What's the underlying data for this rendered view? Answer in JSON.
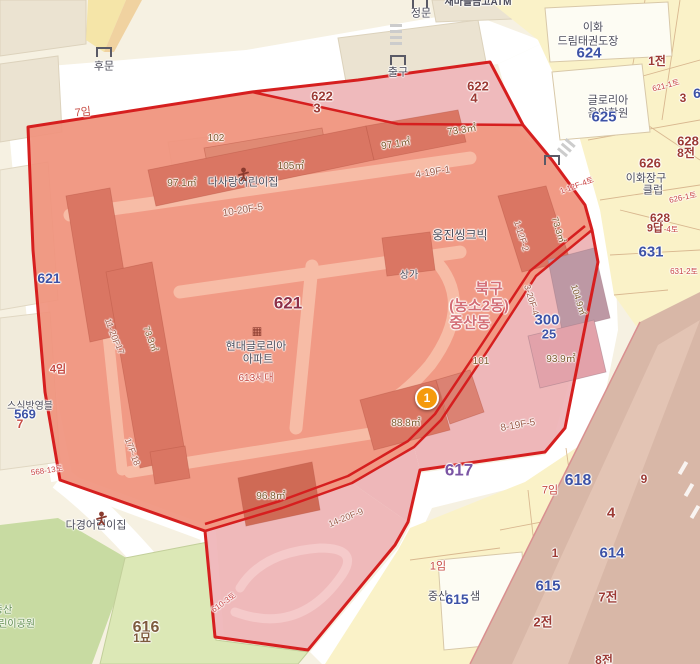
{
  "map": {
    "name": "cadastral-parcel-map",
    "admin_label": [
      "북구",
      "(농소2동)",
      "중산동"
    ],
    "selected_overlay": "red-parcel-selection",
    "marker": {
      "label": "1"
    }
  },
  "colors": {
    "dark": "#4c4c5a",
    "blue": "#3d52a6",
    "parcel": "#9c3a34",
    "m621": "#8e3048",
    "p617": "#7b55a4",
    "rose": "#d46e76",
    "red": "#c64a42",
    "redsmall": "#c84444",
    "meas": "#7d5a2e",
    "floor": "#9c5b49",
    "green": "#5d8b4a",
    "brown": "#7d5a3c",
    "overlay_fill": "#f0937d",
    "overlay_building": "#da7663",
    "overlay_pink": "#edb0b5",
    "border_red": "#d61f1f",
    "road_white": "#ffffff",
    "base_cream": "#f6f1e2",
    "parcel_yellow": "#faf2c8",
    "park_green": "#dce8b6",
    "marker_orange": "#f59a0c"
  },
  "labels": [
    {
      "t": "새마을금고ATM",
      "x": 478,
      "y": 3,
      "c": "dark",
      "s": 10,
      "b": 1
    },
    {
      "t": "후문",
      "x": 104,
      "y": 67,
      "c": "dark",
      "s": 11
    },
    {
      "t": "정문",
      "x": 421,
      "y": 14,
      "c": "dark",
      "s": 11
    },
    {
      "t": "출구",
      "x": 398,
      "y": 73,
      "c": "dark",
      "s": 11
    },
    {
      "t": "7임",
      "x": 83,
      "y": 113,
      "c": "red",
      "s": 11,
      "r": -6
    },
    {
      "t": "622",
      "x": 322,
      "y": 96,
      "c": "parcel",
      "s": 13,
      "b": 1
    },
    {
      "t": "3",
      "x": 317,
      "y": 108,
      "c": "parcel",
      "s": 13,
      "b": 1
    },
    {
      "t": "622",
      "x": 478,
      "y": 86,
      "c": "parcel",
      "s": 13,
      "b": 1
    },
    {
      "t": "4",
      "x": 474,
      "y": 98,
      "c": "parcel",
      "s": 13,
      "b": 1
    },
    {
      "t": "이화",
      "x": 593,
      "y": 28,
      "c": "dark",
      "s": 11
    },
    {
      "t": "드림태권도장",
      "x": 588,
      "y": 42,
      "c": "dark",
      "s": 11
    },
    {
      "t": "624",
      "x": 589,
      "y": 53,
      "c": "blue",
      "s": 15,
      "b": 1
    },
    {
      "t": "1전",
      "x": 657,
      "y": 61,
      "c": "parcel",
      "s": 12,
      "b": 1
    },
    {
      "t": "글로리아",
      "x": 608,
      "y": 101,
      "c": "dark",
      "s": 11
    },
    {
      "t": "음악학원",
      "x": 608,
      "y": 114,
      "c": "dark",
      "s": 11
    },
    {
      "t": "625",
      "x": 604,
      "y": 117,
      "c": "blue",
      "s": 15,
      "b": 1
    },
    {
      "t": "621-1토",
      "x": 666,
      "y": 86,
      "c": "redsmall",
      "s": 8,
      "r": -15
    },
    {
      "t": "3",
      "x": 683,
      "y": 98,
      "c": "parcel",
      "s": 12,
      "b": 1
    },
    {
      "t": "6",
      "x": 697,
      "y": 93,
      "c": "blue",
      "s": 14,
      "b": 1
    },
    {
      "t": "628",
      "x": 688,
      "y": 141,
      "c": "parcel",
      "s": 13,
      "b": 1
    },
    {
      "t": "8전",
      "x": 686,
      "y": 153,
      "c": "parcel",
      "s": 12,
      "b": 1
    },
    {
      "t": "626",
      "x": 650,
      "y": 163,
      "c": "parcel",
      "s": 13,
      "b": 1
    },
    {
      "t": "이화장구",
      "x": 646,
      "y": 179,
      "c": "dark",
      "s": 11
    },
    {
      "t": "클럽",
      "x": 653,
      "y": 191,
      "c": "dark",
      "s": 11
    },
    {
      "t": "626-1토",
      "x": 683,
      "y": 198,
      "c": "redsmall",
      "s": 8,
      "r": -12
    },
    {
      "t": "628",
      "x": 660,
      "y": 218,
      "c": "parcel",
      "s": 12,
      "b": 1
    },
    {
      "t": "9답",
      "x": 655,
      "y": 229,
      "c": "parcel",
      "s": 11,
      "b": 1
    },
    {
      "t": "-4토",
      "x": 671,
      "y": 230,
      "c": "redsmall",
      "s": 8
    },
    {
      "t": "631",
      "x": 651,
      "y": 252,
      "c": "blue",
      "s": 15,
      "b": 1
    },
    {
      "t": "631-2토",
      "x": 684,
      "y": 272,
      "c": "redsmall",
      "s": 8
    },
    {
      "t": "1-12F-4토",
      "x": 577,
      "y": 186,
      "c": "redsmall",
      "s": 8,
      "r": -20
    },
    {
      "t": "102",
      "x": 216,
      "y": 139,
      "c": "meas",
      "s": 10
    },
    {
      "t": "97.1㎡",
      "x": 182,
      "y": 184,
      "c": "meas",
      "s": 10
    },
    {
      "t": "다사랑어린이집",
      "x": 243,
      "y": 183,
      "c": "dark",
      "s": 11
    },
    {
      "t": "105㎡",
      "x": 291,
      "y": 167,
      "c": "meas",
      "s": 10
    },
    {
      "t": "10-20F-5",
      "x": 243,
      "y": 211,
      "c": "floor",
      "s": 10,
      "r": -9
    },
    {
      "t": "97.1㎡",
      "x": 396,
      "y": 145,
      "c": "meas",
      "s": 10,
      "r": -9
    },
    {
      "t": "73.3㎡",
      "x": 462,
      "y": 131,
      "c": "meas",
      "s": 10,
      "r": -9
    },
    {
      "t": "4-19F-1",
      "x": 433,
      "y": 173,
      "c": "floor",
      "s": 10,
      "r": -9
    },
    {
      "t": "웅진씽크빅",
      "x": 460,
      "y": 235,
      "c": "dark",
      "s": 12
    },
    {
      "t": "1-12F-2",
      "x": 521,
      "y": 236,
      "c": "floor",
      "s": 9,
      "r": 73
    },
    {
      "t": "73.3㎡",
      "x": 558,
      "y": 230,
      "c": "meas",
      "s": 9,
      "r": 73
    },
    {
      "t": "621",
      "x": 288,
      "y": 303,
      "c": "m621",
      "s": 17,
      "b": 1
    },
    {
      "t": "현대글로리아",
      "x": 256,
      "y": 347,
      "c": "dark",
      "s": 11
    },
    {
      "t": "아파트",
      "x": 258,
      "y": 360,
      "c": "dark",
      "s": 11
    },
    {
      "t": "613세대",
      "x": 256,
      "y": 379,
      "c": "red",
      "s": 10
    },
    {
      "t": "상가",
      "x": 409,
      "y": 276,
      "c": "dark",
      "s": 10
    },
    {
      "t": "북구",
      "x": 489,
      "y": 289,
      "c": "rose",
      "s": 15,
      "b": 1
    },
    {
      "t": "(농소2동)",
      "x": 479,
      "y": 306,
      "c": "rose",
      "s": 15,
      "b": 1
    },
    {
      "t": "중산동",
      "x": 470,
      "y": 323,
      "c": "rose",
      "s": 15,
      "b": 1
    },
    {
      "t": "3-20F-4",
      "x": 531,
      "y": 300,
      "c": "floor",
      "s": 9,
      "r": 73
    },
    {
      "t": "300",
      "x": 547,
      "y": 320,
      "c": "blue",
      "s": 15,
      "b": 1
    },
    {
      "t": "25",
      "x": 549,
      "y": 334,
      "c": "blue",
      "s": 13,
      "b": 1
    },
    {
      "t": "104.9㎡",
      "x": 578,
      "y": 300,
      "c": "meas",
      "s": 9,
      "r": 73
    },
    {
      "t": "101",
      "x": 481,
      "y": 362,
      "c": "meas",
      "s": 10
    },
    {
      "t": "93.9㎡",
      "x": 561,
      "y": 360,
      "c": "meas",
      "s": 10
    },
    {
      "t": "11-20F",
      "x": 112,
      "y": 332,
      "c": "floor",
      "s": 9,
      "r": 70
    },
    {
      "t": "-17",
      "x": 119,
      "y": 348,
      "c": "floor",
      "s": 9,
      "r": 70
    },
    {
      "t": "73.3㎡",
      "x": 150,
      "y": 339,
      "c": "meas",
      "s": 9,
      "r": 70
    },
    {
      "t": "17F-18",
      "x": 132,
      "y": 452,
      "c": "floor",
      "s": 9,
      "r": 70
    },
    {
      "t": "88.8㎡",
      "x": 406,
      "y": 424,
      "c": "meas",
      "s": 10
    },
    {
      "t": "8-19F-5",
      "x": 518,
      "y": 426,
      "c": "floor",
      "s": 10,
      "r": -10
    },
    {
      "t": "617",
      "x": 459,
      "y": 470,
      "c": "p617",
      "s": 17,
      "b": 1
    },
    {
      "t": "96.8㎡",
      "x": 271,
      "y": 497,
      "c": "meas",
      "s": 10
    },
    {
      "t": "다경어린이집",
      "x": 96,
      "y": 526,
      "c": "dark",
      "s": 11
    },
    {
      "t": "14-20F-9",
      "x": 346,
      "y": 518,
      "c": "floor",
      "s": 9,
      "r": -22
    },
    {
      "t": "568-13토",
      "x": 47,
      "y": 471,
      "c": "redsmall",
      "s": 8,
      "r": -8
    },
    {
      "t": "스식방영블",
      "x": 30,
      "y": 407,
      "c": "dark",
      "s": 10
    },
    {
      "t": "569",
      "x": 25,
      "y": 414,
      "c": "blue",
      "s": 13,
      "b": 1
    },
    {
      "t": "7",
      "x": 20,
      "y": 424,
      "c": "red",
      "s": 12,
      "b": 1
    },
    {
      "t": "621",
      "x": 49,
      "y": 278,
      "c": "blue",
      "s": 14,
      "b": 1
    },
    {
      "t": "4임",
      "x": 58,
      "y": 370,
      "c": "red",
      "s": 11,
      "b": 1
    },
    {
      "t": "7임",
      "x": 550,
      "y": 491,
      "c": "red",
      "s": 11
    },
    {
      "t": "618",
      "x": 578,
      "y": 481,
      "c": "blue",
      "s": 16,
      "b": 1
    },
    {
      "t": "9",
      "x": 644,
      "y": 479,
      "c": "parcel",
      "s": 12,
      "b": 1
    },
    {
      "t": "4",
      "x": 611,
      "y": 513,
      "c": "parcel",
      "s": 15,
      "b": 1
    },
    {
      "t": "614",
      "x": 612,
      "y": 553,
      "c": "blue",
      "s": 15,
      "b": 1
    },
    {
      "t": "1",
      "x": 555,
      "y": 553,
      "c": "parcel",
      "s": 12,
      "b": 1
    },
    {
      "t": "615",
      "x": 548,
      "y": 586,
      "c": "blue",
      "s": 15,
      "b": 1
    },
    {
      "t": "7전",
      "x": 608,
      "y": 597,
      "c": "parcel",
      "s": 13,
      "b": 1
    },
    {
      "t": "2전",
      "x": 543,
      "y": 622,
      "c": "parcel",
      "s": 13,
      "b": 1
    },
    {
      "t": "8전",
      "x": 604,
      "y": 660,
      "c": "parcel",
      "s": 12,
      "b": 1
    },
    {
      "t": "중산",
      "x": 438,
      "y": 597,
      "c": "dark",
      "s": 11
    },
    {
      "t": "615",
      "x": 457,
      "y": 599,
      "c": "blue",
      "s": 14,
      "b": 1
    },
    {
      "t": "샘",
      "x": 475,
      "y": 597,
      "c": "dark",
      "s": 11
    },
    {
      "t": "1임",
      "x": 438,
      "y": 567,
      "c": "red",
      "s": 11
    },
    {
      "t": "중산",
      "x": 3,
      "y": 611,
      "c": "green",
      "s": 10
    },
    {
      "t": "어린이공원",
      "x": 12,
      "y": 625,
      "c": "green",
      "s": 10
    },
    {
      "t": "616",
      "x": 146,
      "y": 628,
      "c": "brown",
      "s": 16,
      "b": 1
    },
    {
      "t": "1묘",
      "x": 142,
      "y": 638,
      "c": "brown",
      "s": 12,
      "b": 1
    },
    {
      "t": "610-3토",
      "x": 224,
      "y": 603,
      "c": "redsmall",
      "s": 8,
      "r": -35
    }
  ],
  "icons": [
    {
      "n": "gate-icon",
      "x": 104,
      "y": 52
    },
    {
      "n": "gate-icon",
      "x": 420,
      "y": 3
    },
    {
      "n": "gate-icon",
      "x": 398,
      "y": 60
    },
    {
      "n": "gate-icon",
      "x": 552,
      "y": 160
    },
    {
      "n": "childcare-icon",
      "x": 237,
      "y": 167
    },
    {
      "n": "childcare-icon",
      "x": 95,
      "y": 511
    },
    {
      "n": "apartment-icon",
      "x": 257,
      "y": 331
    }
  ],
  "marker": {
    "label": "1",
    "x": 425,
    "y": 398
  }
}
